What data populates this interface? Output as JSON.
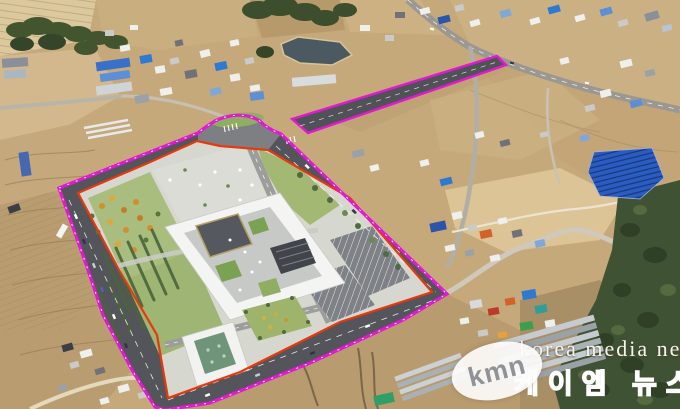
{
  "image": {
    "type": "aerial-photo",
    "description": "Drone aerial view of a rural Korean town with a new public-complex masterplan overlaid; magenta dashed site boundary with access-road corridor, red parcel boundary, white ring-shaped building render.",
    "width_px": 680,
    "height_px": 409
  },
  "watermark": {
    "logo": "kmn",
    "name_en": "korea media news",
    "name_ko": "케이엠 뉴스"
  },
  "overlays": {
    "site_boundary_color": "#e318d3",
    "parcel_boundary_color": "#e8380d",
    "boundary_dash_color": "#ffffff"
  },
  "palette": {
    "terrain": "#c6a97b",
    "ring_road": "#54555a",
    "plan_ground": "#d6d8d0",
    "lawn": "#a9bd7e",
    "water": "#4a5a60",
    "forest": "#3f5233",
    "solar": "#2b5cc0",
    "building_white": "#f4f4f2"
  }
}
